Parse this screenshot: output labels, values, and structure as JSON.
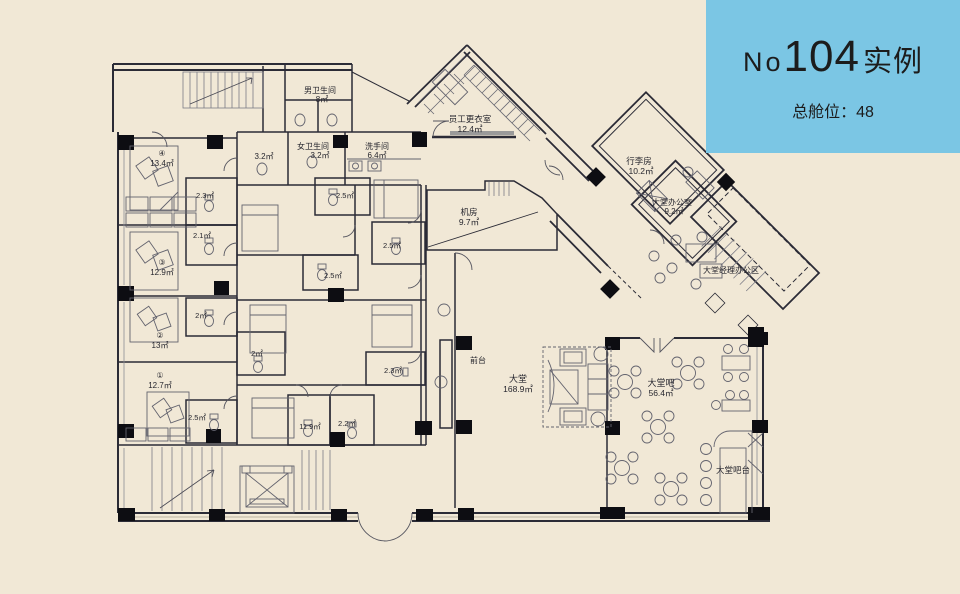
{
  "info_box": {
    "prefix": "No",
    "number": "104",
    "suffix": "实例",
    "capacity": "总舱位：48",
    "bg_color": "#7bc6e4"
  },
  "plan": {
    "background_color": "#f1e8d6",
    "wall_color": "#2b2b36",
    "labels": [
      {
        "text": "男卫生间",
        "x": 320,
        "y": 93,
        "fs": 8
      },
      {
        "text": "8㎡",
        "x": 322,
        "y": 102,
        "fs": 8
      },
      {
        "text": "女卫生间",
        "x": 313,
        "y": 149,
        "fs": 8
      },
      {
        "text": "3.2㎡",
        "x": 320,
        "y": 158,
        "fs": 8
      },
      {
        "text": "洗手间",
        "x": 377,
        "y": 149,
        "fs": 8
      },
      {
        "text": "6.4㎡",
        "x": 377,
        "y": 158,
        "fs": 8
      },
      {
        "text": "3.2㎡",
        "x": 264,
        "y": 159,
        "fs": 8
      },
      {
        "text": "员工更衣室",
        "x": 470,
        "y": 122,
        "fs": 8.5
      },
      {
        "text": "12.4㎡",
        "x": 470,
        "y": 132,
        "fs": 8.5
      },
      {
        "text": "④",
        "x": 162,
        "y": 156,
        "fs": 8
      },
      {
        "text": "13.4㎡",
        "x": 162,
        "y": 166,
        "fs": 8
      },
      {
        "text": "2.3㎡",
        "x": 205,
        "y": 198,
        "fs": 7.5
      },
      {
        "text": "2.1㎡",
        "x": 202,
        "y": 238,
        "fs": 7.5
      },
      {
        "text": "③",
        "x": 162,
        "y": 265,
        "fs": 8
      },
      {
        "text": "12.9㎡",
        "x": 162,
        "y": 275,
        "fs": 8
      },
      {
        "text": "2㎡",
        "x": 201,
        "y": 318,
        "fs": 7.5
      },
      {
        "text": "②",
        "x": 160,
        "y": 338,
        "fs": 8
      },
      {
        "text": "13㎡",
        "x": 160,
        "y": 348,
        "fs": 8
      },
      {
        "text": "①",
        "x": 160,
        "y": 378,
        "fs": 8
      },
      {
        "text": "12.7㎡",
        "x": 160,
        "y": 388,
        "fs": 8
      },
      {
        "text": "2.5㎡",
        "x": 197,
        "y": 420,
        "fs": 7.5
      },
      {
        "text": "2.5㎡",
        "x": 345,
        "y": 198,
        "fs": 7.5
      },
      {
        "text": "2.5㎡",
        "x": 392,
        "y": 248,
        "fs": 7.5
      },
      {
        "text": "2.5㎡",
        "x": 333,
        "y": 278,
        "fs": 7.5
      },
      {
        "text": "2㎡",
        "x": 257,
        "y": 356,
        "fs": 7.5
      },
      {
        "text": "2.3㎡",
        "x": 393,
        "y": 373,
        "fs": 7.5
      },
      {
        "text": "11.9㎡",
        "x": 310,
        "y": 429,
        "fs": 7.5
      },
      {
        "text": "2.2㎡",
        "x": 347,
        "y": 426,
        "fs": 7.5
      },
      {
        "text": "机房",
        "x": 469,
        "y": 215,
        "fs": 8.5
      },
      {
        "text": "9.7㎡",
        "x": 469,
        "y": 225,
        "fs": 8.5
      },
      {
        "text": "行李房",
        "x": 639,
        "y": 164,
        "fs": 8.5
      },
      {
        "text": "10.2㎡",
        "x": 641,
        "y": 174,
        "fs": 8.5
      },
      {
        "text": "大堂办公室",
        "x": 672,
        "y": 205,
        "fs": 8
      },
      {
        "text": "9.2㎡",
        "x": 674,
        "y": 214,
        "fs": 8
      },
      {
        "text": "大堂经理办公区",
        "x": 731,
        "y": 273,
        "fs": 8
      },
      {
        "text": "前台",
        "x": 478,
        "y": 363,
        "fs": 8
      },
      {
        "text": "大堂",
        "x": 518,
        "y": 382,
        "fs": 9
      },
      {
        "text": "168.9㎡",
        "x": 518,
        "y": 392,
        "fs": 8.5
      },
      {
        "text": "大堂吧",
        "x": 661,
        "y": 386,
        "fs": 9
      },
      {
        "text": "56.4㎡",
        "x": 661,
        "y": 396,
        "fs": 8.5
      },
      {
        "text": "大堂吧台",
        "x": 733,
        "y": 473,
        "fs": 8.5
      }
    ]
  }
}
